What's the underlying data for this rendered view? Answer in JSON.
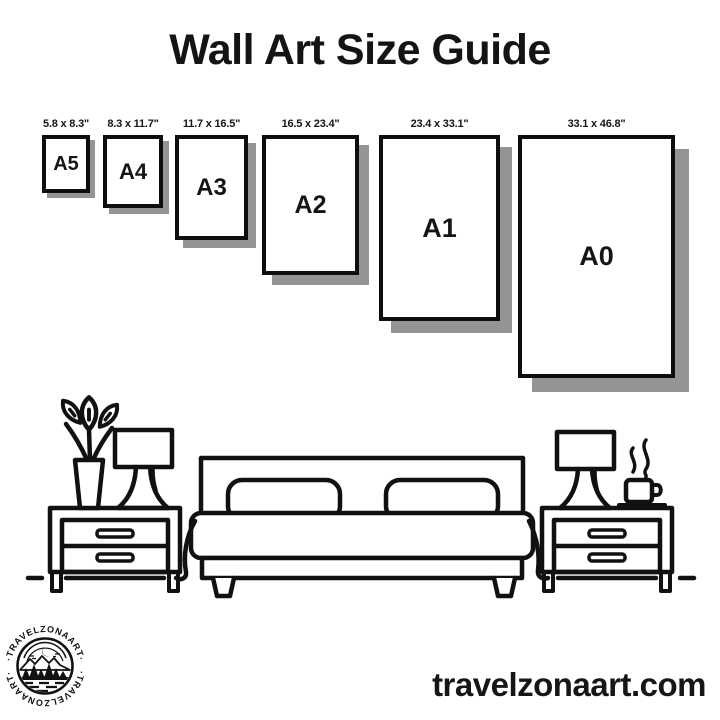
{
  "title": "Wall Art Size Guide",
  "sizes": [
    {
      "name": "A5",
      "dimensions": "5.8 x 8.3\""
    },
    {
      "name": "A4",
      "dimensions": "8.3 x 11.7\""
    },
    {
      "name": "A3",
      "dimensions": "11.7 x 16.5\""
    },
    {
      "name": "A2",
      "dimensions": "16.5 x 23.4\""
    },
    {
      "name": "A1",
      "dimensions": "23.4 x 33.1\""
    },
    {
      "name": "A0",
      "dimensions": "33.1 x 46.8\""
    }
  ],
  "footer": {
    "website": "travelzonaart.com",
    "logo_arc_text_top": "·TRAVELZONAART·",
    "logo_arc_text_bottom": "·TRAVELZONAART·"
  },
  "colors": {
    "ink": "#111111",
    "paper_shadow": "#949494",
    "background": "#ffffff"
  },
  "illustration_icons": [
    "plant-vase-icon",
    "table-lamp-icon",
    "nightstand-icon",
    "double-bed-icon",
    "coffee-cup-icon"
  ]
}
